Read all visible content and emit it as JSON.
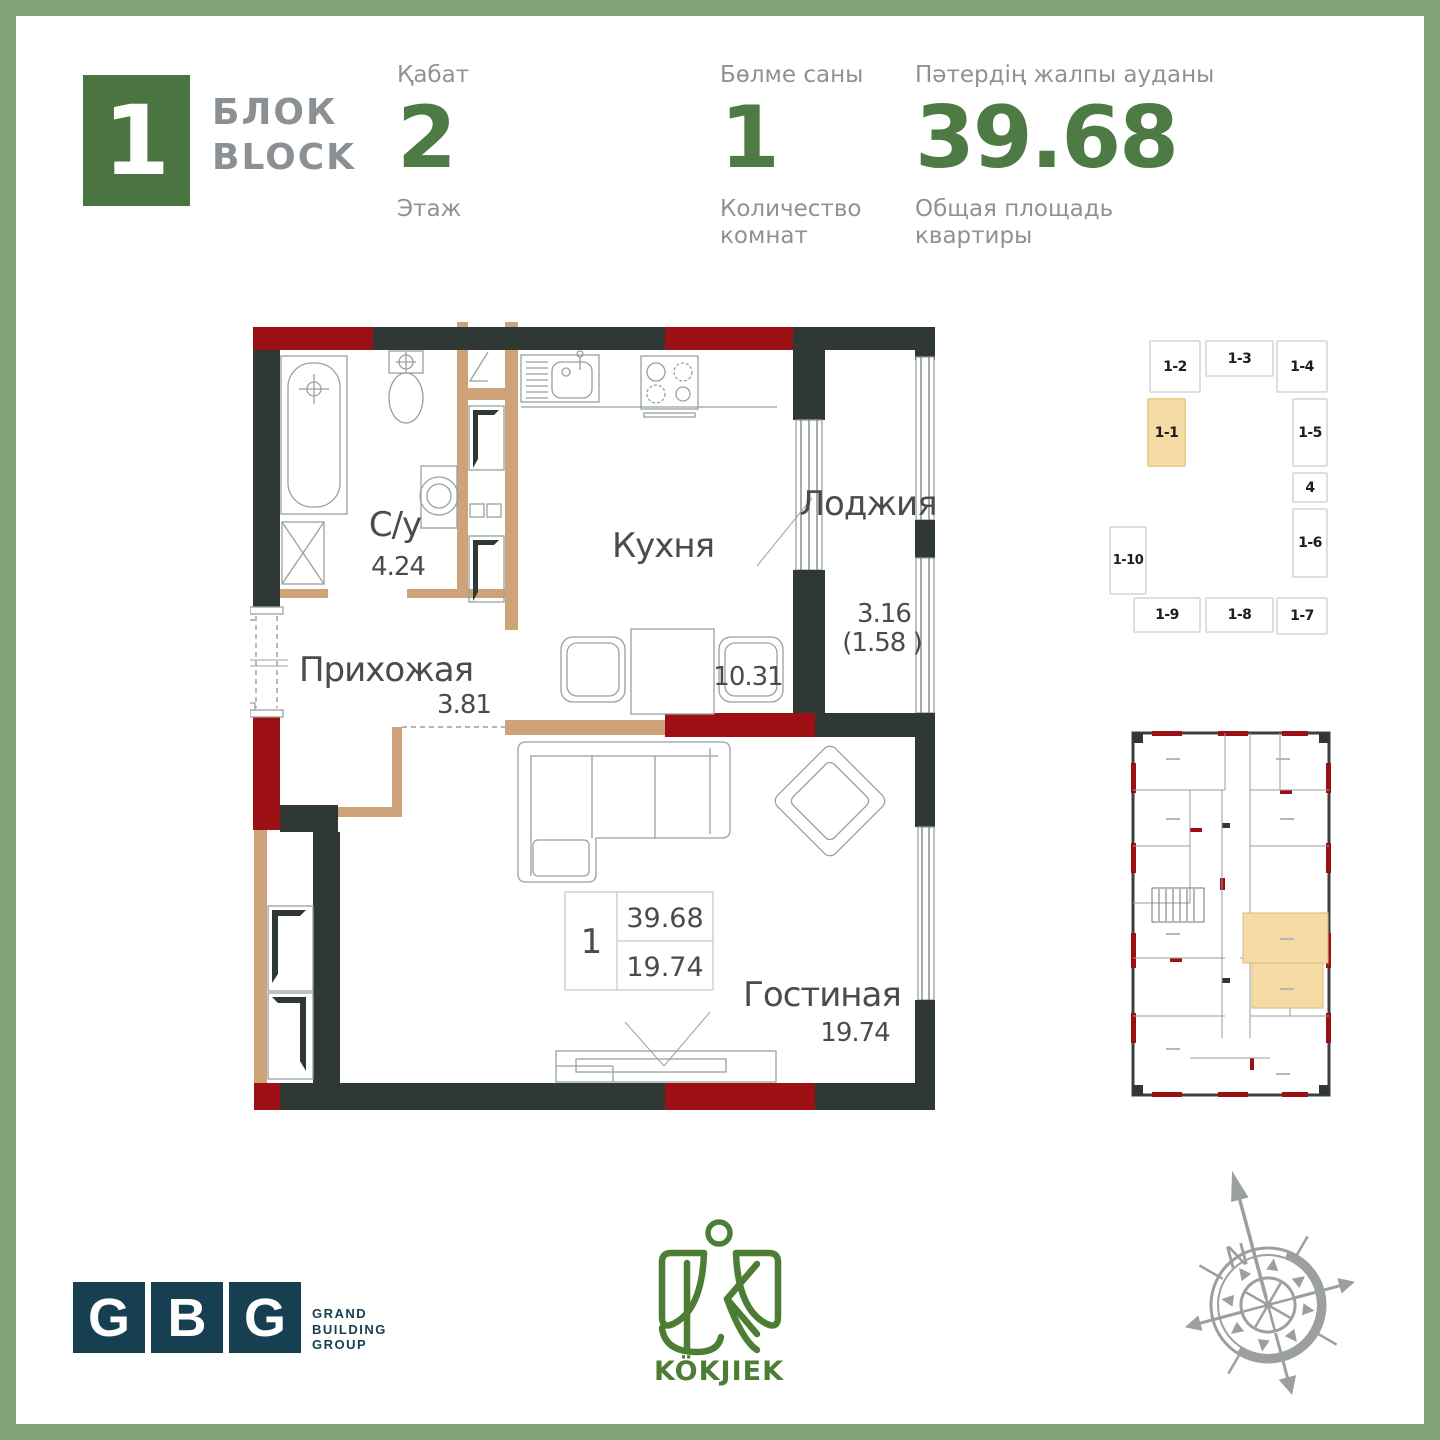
{
  "colors": {
    "frame_green": "#82a375",
    "accent_green": "#4e7a44",
    "block_green": "#4b7540",
    "label_gray": "#8e9296",
    "wall_dark": "#2f3835",
    "wall_red": "#9c1014",
    "wall_tan": "#cfa379",
    "highlight_tan": "#f7dba4",
    "gbg_teal": "#164051",
    "kokjiek_green": "#4d7d35",
    "compass_gray": "#9b9fa0"
  },
  "header": {
    "block": {
      "number": "1",
      "title_kk": "БЛОК",
      "title_en": "BLOCK"
    },
    "floor": {
      "label_kk": "Қабат",
      "value": "2",
      "label_ru": "Этаж"
    },
    "rooms": {
      "label_kk": "Бөлме саны",
      "value": "1",
      "label_ru": "Количество комнат"
    },
    "area": {
      "label_kk": "Пәтердің жалпы ауданы",
      "value": "39.68",
      "label_ru": "Общая площадь квартиры"
    }
  },
  "plan": {
    "bathroom": {
      "name": "С/у",
      "area": "4.24"
    },
    "kitchen": {
      "name": "Кухня",
      "area": "10.31"
    },
    "loggia": {
      "name": "Лоджия",
      "area": "3.16",
      "area_reduced": "(1.58 )"
    },
    "hallway": {
      "name": "Прихожая",
      "area": "3.81"
    },
    "living": {
      "name": "Гостиная",
      "area": "19.74"
    },
    "stamp": {
      "rooms": "1",
      "total_area": "39.68",
      "living_area": "19.74"
    }
  },
  "unit_map": {
    "highlighted_unit": "1-1",
    "units": [
      "1-2",
      "1-3",
      "1-4",
      "1-1",
      "1-5",
      "4",
      "1-6",
      "1-10",
      "1-9",
      "1-8",
      "1-7"
    ]
  },
  "footer": {
    "gbg": {
      "letters": [
        "G",
        "B",
        "G"
      ],
      "caption_lines": [
        "GRAND",
        "BUILDING",
        "GROUP"
      ]
    },
    "kokjiek": {
      "wordmark": "KÖKJIEK"
    },
    "compass": {
      "north": "N"
    }
  }
}
